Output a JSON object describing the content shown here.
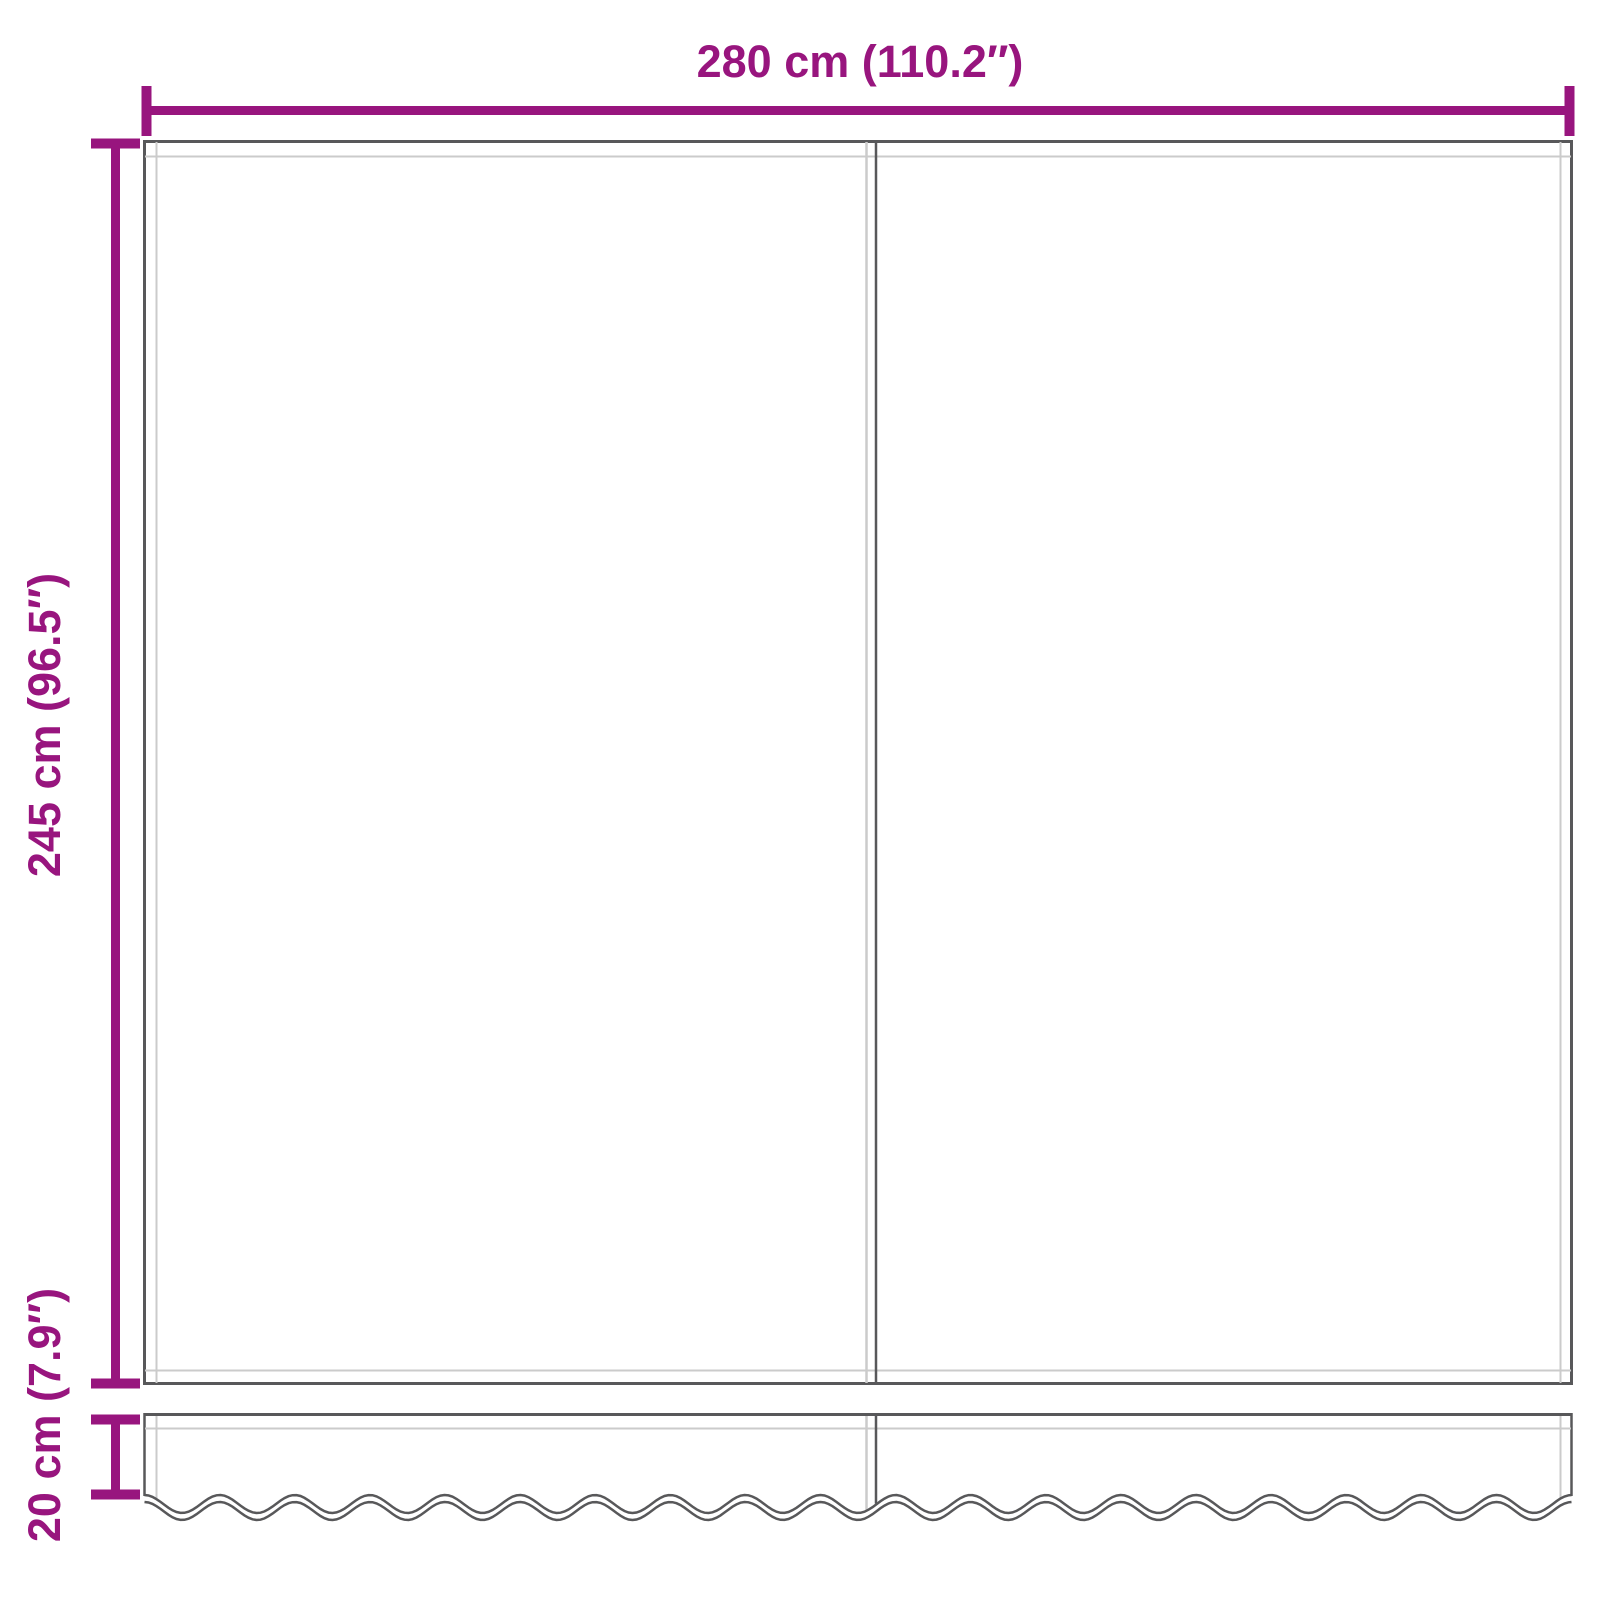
{
  "diagram": {
    "type": "product-dimension-diagram",
    "labels": {
      "width": "280 cm (110.2″)",
      "height": "245 cm (96.5″)",
      "valance": "20 cm (7.9″)"
    },
    "parts": {
      "main_panel": "awning fabric panel with center seam",
      "valance": "scalloped valance strip"
    },
    "colors": {
      "dimension_accent": "#98157E",
      "panel_outline": "#58585A",
      "hem_line": "#CBCBCB",
      "background": "#FFFFFF"
    }
  }
}
